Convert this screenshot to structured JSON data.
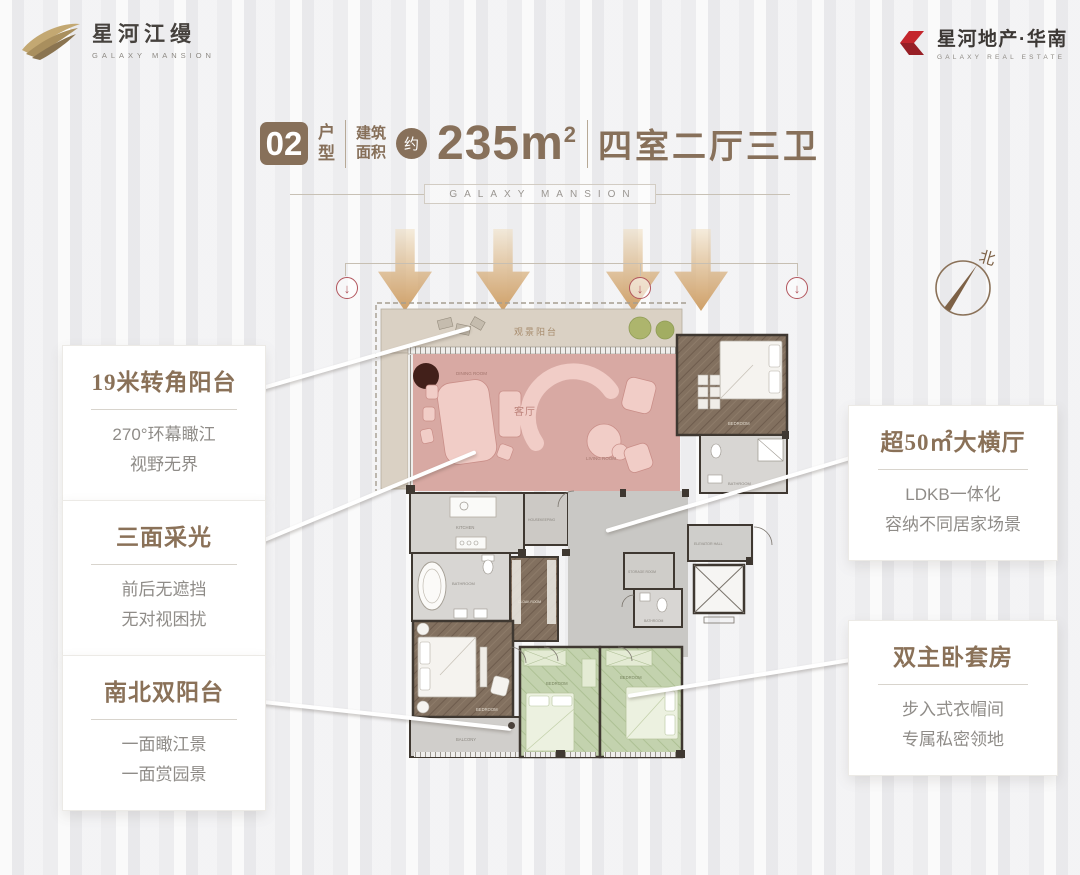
{
  "header": {
    "logo_left": {
      "cn": "星河江缦",
      "en": "GALAXY MANSION"
    },
    "logo_right": {
      "cn": "星河地产·华南",
      "en": "GALAXY REAL ESTATE"
    }
  },
  "title": {
    "unit_number": "02",
    "unit_label_1": "户",
    "unit_label_2": "型",
    "area_label_1": "建筑",
    "area_label_2": "面积",
    "approx": "约",
    "area_value": "235m",
    "area_sup": "2",
    "layout": "四室二厅三卫",
    "subtitle": "GALAXY MANSION"
  },
  "compass": {
    "north": "北"
  },
  "icons": {
    "circle_arrow": "↓"
  },
  "callouts": {
    "left": [
      {
        "title": "19米转角阳台",
        "lines": [
          "270°环幕瞰江",
          "视野无界"
        ]
      },
      {
        "title": "三面采光",
        "lines": [
          "前后无遮挡",
          "无对视困扰"
        ]
      },
      {
        "title": "南北双阳台",
        "lines": [
          "一面瞰江景",
          "一面赏园景"
        ]
      }
    ],
    "right": [
      {
        "title": "超50㎡大横厅",
        "lines": [
          "LDKB一体化",
          "容纳不同居家场景"
        ]
      },
      {
        "title": "双主卧套房",
        "lines": [
          "步入式衣帽间",
          "专属私密领地"
        ]
      }
    ]
  },
  "floorplan": {
    "rooms": {
      "view_balcony": "观景阳台",
      "living_cn": "客厅",
      "dining": "DINING ROOM",
      "living_en": "LIVING ROOM",
      "bedroom_tr": "BEDROOM",
      "bathroom_tr": "BATHROOM",
      "kitchen": "KITCHEN",
      "housekeeping": "HOUSEKEEPING",
      "elevator_hall": "ELEVATOR HALL",
      "storage": "STORAGE ROOM",
      "bathroom_mid": "BATHROOM",
      "bathroom_master": "BATHROOM",
      "cloak": "CLOAK ROOM",
      "bedroom_master": "BEDROOM",
      "balcony_south": "BALCONY",
      "bedroom_g1": "BEDROOM",
      "bedroom_g2": "BEDROOM"
    }
  },
  "colors": {
    "accent_brown": "#87705a",
    "logo_red": "#c2262d",
    "highlight_pink": "#d8a9a3",
    "highlight_green": "#c3d2ae",
    "arrow_tan": "#cfa068",
    "pointer_red": "#b2555c"
  }
}
